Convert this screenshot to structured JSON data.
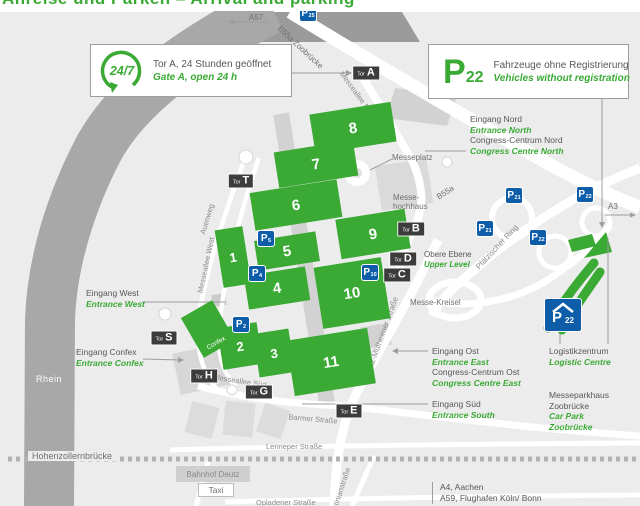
{
  "cropped_top_title": "Anreise und Parken  –  Arrival and parking",
  "info_boxes": {
    "gate_a": {
      "icon": "24/7",
      "de": "Tor A, 24 Stunden geöffnet",
      "en": "Gate A, open 24 h"
    },
    "p22": {
      "icon_p": "P",
      "icon_sub": "22",
      "de": "Fahrzeuge ohne Registrierung",
      "en": "Vehicles without registration"
    }
  },
  "halls": [
    {
      "n": "1"
    },
    {
      "n": "2"
    },
    {
      "n": "3"
    },
    {
      "n": "4"
    },
    {
      "n": "5"
    },
    {
      "n": "6"
    },
    {
      "n": "7"
    },
    {
      "n": "8"
    },
    {
      "n": "9"
    },
    {
      "n": "10"
    },
    {
      "n": "11"
    }
  ],
  "gates": [
    {
      "prefix": "Tor",
      "letter": "A"
    },
    {
      "prefix": "Tor",
      "letter": "T"
    },
    {
      "prefix": "Tor",
      "letter": "B"
    },
    {
      "prefix": "Tor",
      "letter": "D"
    },
    {
      "prefix": "Tor",
      "letter": "C"
    },
    {
      "prefix": "Tor",
      "letter": "S"
    },
    {
      "prefix": "Tor",
      "letter": "H"
    },
    {
      "prefix": "Tor",
      "letter": "G"
    },
    {
      "prefix": "Tor",
      "letter": "E"
    }
  ],
  "parking_small": [
    {
      "p": "P",
      "sub": "25"
    },
    {
      "p": "P",
      "sub": "5"
    },
    {
      "p": "P",
      "sub": "4"
    },
    {
      "p": "P",
      "sub": "2"
    },
    {
      "p": "P",
      "sub": "10"
    },
    {
      "p": "P",
      "sub": "21"
    },
    {
      "p": "P",
      "sub": "22"
    },
    {
      "p": "P",
      "sub": "21"
    },
    {
      "p": "P",
      "sub": "22"
    }
  ],
  "parking_garage": {
    "p": "P",
    "sub": "22"
  },
  "entrances": {
    "nord": {
      "de": "Eingang Nord",
      "en": "Entrance North",
      "cc_de": "Congress-Centrum Nord",
      "cc_en": "Congress Centre North"
    },
    "ost": {
      "de": "Eingang Ost",
      "en": "Entrance East",
      "cc_de": "Congress-Centrum Ost",
      "cc_en": "Congress Centre East"
    },
    "sued": {
      "de": "Eingang Süd",
      "en": "Entrance South"
    },
    "west": {
      "de": "Eingang West",
      "en": "Entrance West"
    },
    "confex": {
      "de": "Eingang Confex",
      "en": "Entrance Confex"
    }
  },
  "labels": {
    "obere_ebene_de": "Obere Ebene",
    "obere_ebene_en": "Upper Level",
    "messe_kreisel": "Messe-Kreisel",
    "messeplatz": "Messeplatz",
    "messe_hochhaus_1": "Messe-",
    "messe_hochhaus_2": "hochhaus",
    "confex": "Confex",
    "rhein": "Rhein",
    "hohenzollernbruecke": "Hohenzollernbrücke",
    "bahnhof": "Bahnhof Deutz",
    "taxi": "Taxi"
  },
  "logistics": {
    "de": "Logistikzentrum",
    "en": "Logistic Centre"
  },
  "carpark_zoobruecke": {
    "de1": "Messeparkhaus",
    "de2": "Zoobrücke",
    "en1": "Car Park",
    "en2": "Zoobrücke"
  },
  "destinations": {
    "l1": "A4, Aachen",
    "l2": "A59, Flughafen Köln/ Bonn"
  },
  "motorways": {
    "a57": "A57",
    "a3": "A3",
    "b55a": "B55a",
    "b55a_zoobruecke": "B55a Zoobrücke"
  },
  "streets": {
    "messeallee_nord": "Messeallee Nord",
    "auenweg": "Auenweg",
    "messeallee_west": "Messeallee West",
    "messeallee_sued": "Messeallee Süd",
    "deutz_muelheimer": "Deutz-Mülheimer Straße",
    "pfaelzischer_ring": "Pfälzischer Ring",
    "barmer": "Barmer Straße",
    "lenneper": "Lenneper Straße",
    "opladener": "Opladener Straße",
    "justinian": "Justinianstraße"
  },
  "colors": {
    "green": "#3aaa35",
    "blue": "#0e5da9",
    "sign_dark": "#3c3c3b",
    "text_gray": "#575756"
  }
}
